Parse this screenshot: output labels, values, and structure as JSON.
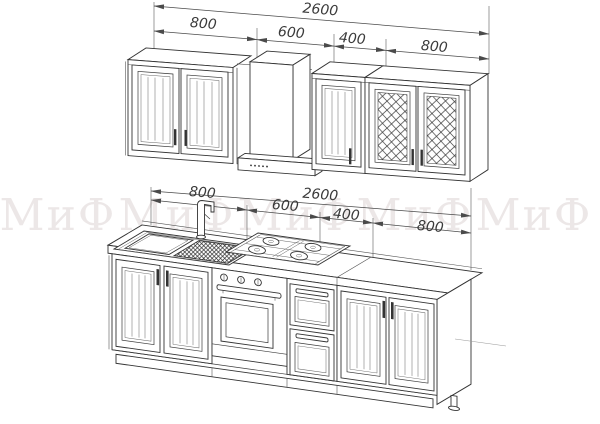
{
  "watermark": {
    "text": "МиФ",
    "instances": 5,
    "color": "#ece7e7"
  },
  "dimensions": {
    "upper_row": {
      "total": "2600",
      "segments": [
        "800",
        "600",
        "400",
        "800"
      ]
    },
    "lower_row": {
      "total": "2600",
      "segments": [
        "800",
        "600",
        "400",
        "800"
      ]
    }
  },
  "colors": {
    "background": "#ffffff",
    "line_ink": "#333333",
    "dimension_ink": "#4a4a4a",
    "watermark": "#ece7e7"
  }
}
